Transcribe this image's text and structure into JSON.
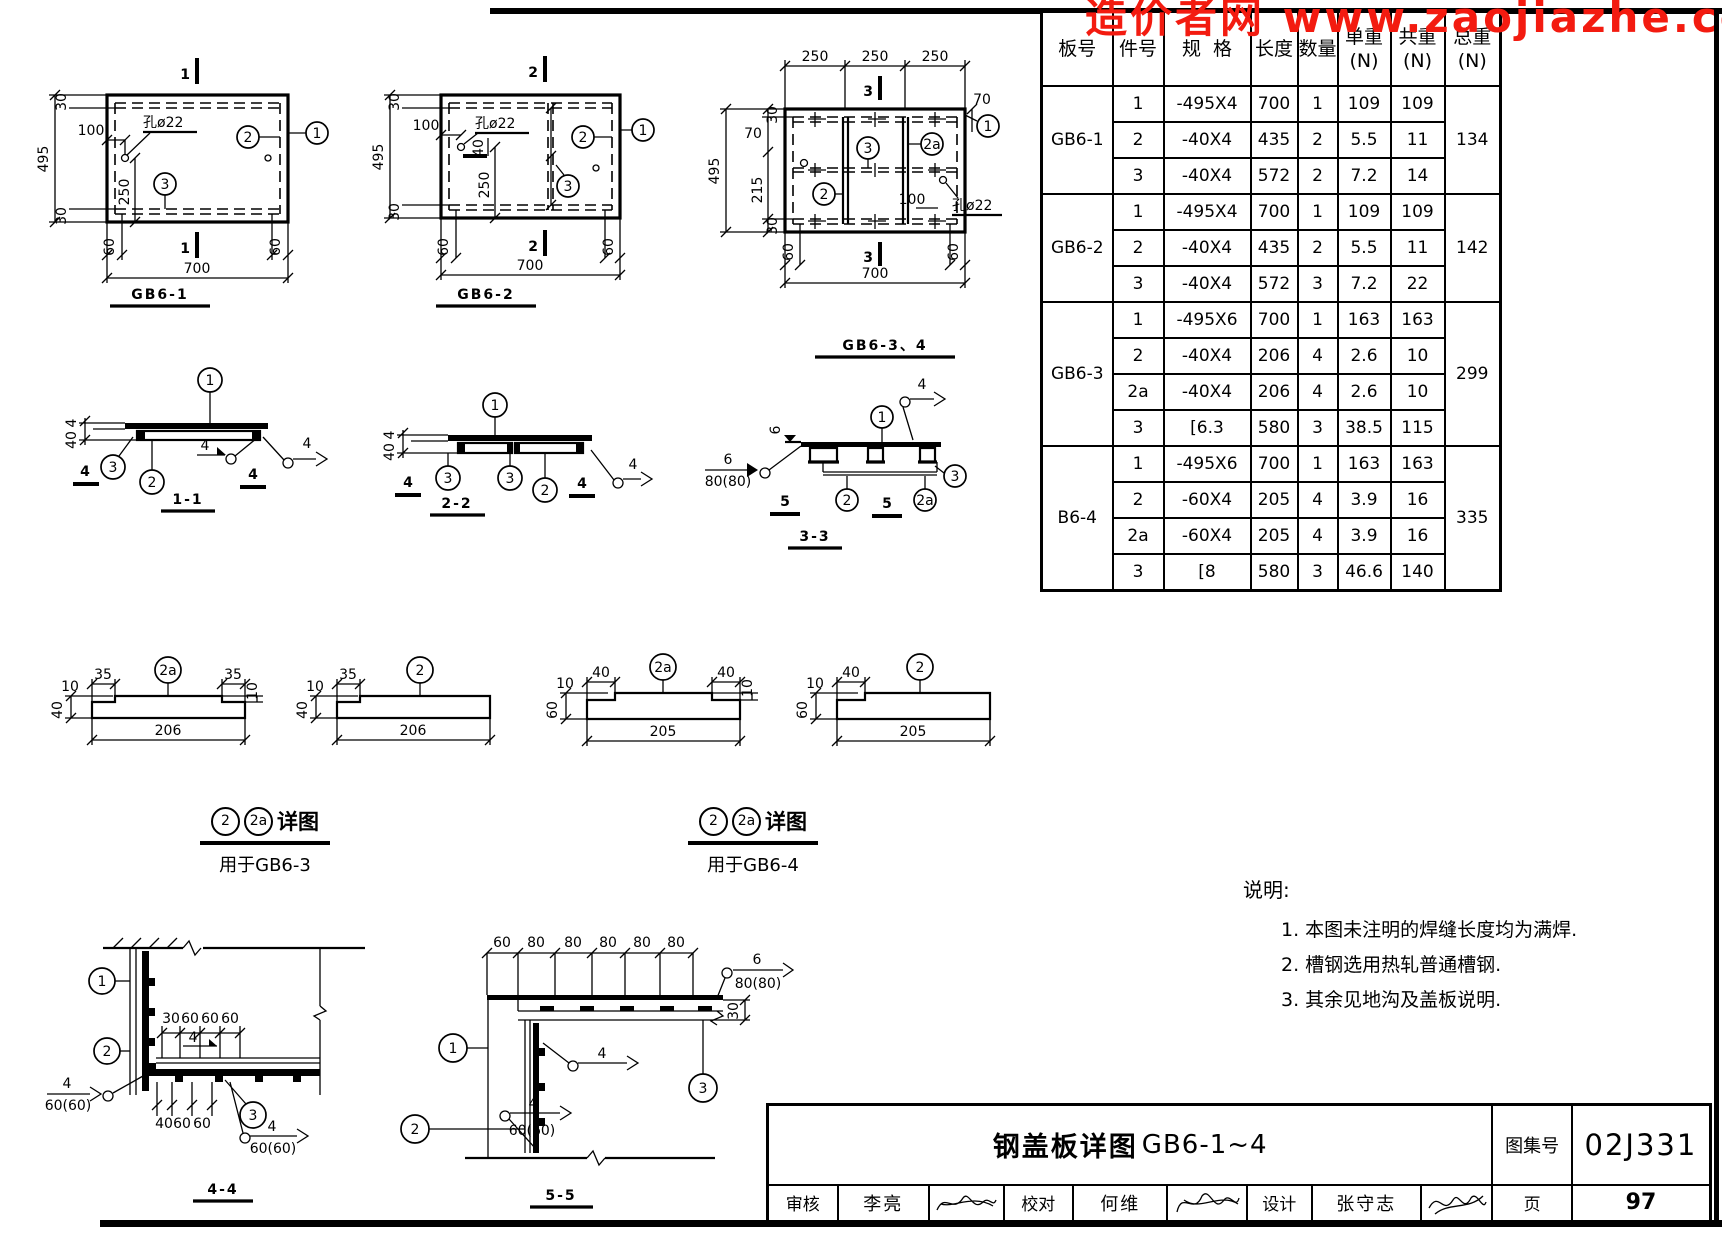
{
  "watermark": "造价者网 www.zaojiazhe.co",
  "table": {
    "headers": {
      "board": "板号",
      "item": "件号",
      "spec": "规  格",
      "len": "长度",
      "qty": "数量",
      "unit": "单重",
      "share": "共重",
      "sum": "总重",
      "n": "(N)"
    },
    "groups": [
      {
        "board": "GB6-1",
        "sum": "134",
        "rows": [
          {
            "item": "1",
            "spec": "-495X4",
            "len": "700",
            "qty": "1",
            "unit": "109",
            "tot": "109"
          },
          {
            "item": "2",
            "spec": "-40X4",
            "len": "435",
            "qty": "2",
            "unit": "5.5",
            "tot": "11"
          },
          {
            "item": "3",
            "spec": "-40X4",
            "len": "572",
            "qty": "2",
            "unit": "7.2",
            "tot": "14"
          }
        ]
      },
      {
        "board": "GB6-2",
        "sum": "142",
        "rows": [
          {
            "item": "1",
            "spec": "-495X4",
            "len": "700",
            "qty": "1",
            "unit": "109",
            "tot": "109"
          },
          {
            "item": "2",
            "spec": "-40X4",
            "len": "435",
            "qty": "2",
            "unit": "5.5",
            "tot": "11"
          },
          {
            "item": "3",
            "spec": "-40X4",
            "len": "572",
            "qty": "3",
            "unit": "7.2",
            "tot": "22"
          }
        ]
      },
      {
        "board": "GB6-3",
        "sum": "299",
        "rows": [
          {
            "item": "1",
            "spec": "-495X6",
            "len": "700",
            "qty": "1",
            "unit": "163",
            "tot": "163"
          },
          {
            "item": "2",
            "spec": "-40X4",
            "len": "206",
            "qty": "4",
            "unit": "2.6",
            "tot": "10"
          },
          {
            "item": "2a",
            "spec": "-40X4",
            "len": "206",
            "qty": "4",
            "unit": "2.6",
            "tot": "10"
          },
          {
            "item": "3",
            "spec": "[6.3",
            "len": "580",
            "qty": "3",
            "unit": "38.5",
            "tot": "115"
          }
        ]
      },
      {
        "board": "B6-4",
        "sum": "335",
        "rows": [
          {
            "item": "1",
            "spec": "-495X6",
            "len": "700",
            "qty": "1",
            "unit": "163",
            "tot": "163"
          },
          {
            "item": "2",
            "spec": "-60X4",
            "len": "205",
            "qty": "4",
            "unit": "3.9",
            "tot": "16"
          },
          {
            "item": "2a",
            "spec": "-60X4",
            "len": "205",
            "qty": "4",
            "unit": "3.9",
            "tot": "16"
          },
          {
            "item": "3",
            "spec": "[8",
            "len": "580",
            "qty": "3",
            "unit": "46.6",
            "tot": "140"
          }
        ]
      }
    ]
  },
  "notes": {
    "title": "说明:",
    "items": [
      "1. 本图未注明的焊缝长度均为满焊.",
      "2. 槽钢选用热轧普通槽钢.",
      "3. 其余见地沟及盖板说明."
    ]
  },
  "titleblock": {
    "title_cn": "钢盖板详图",
    "title_code": "GB6-1~4",
    "atlas_label": "图集号",
    "atlas_no": "02J331",
    "review_label": "审核",
    "reviewer": "李亮",
    "check_label": "校对",
    "checker": "何维",
    "design_label": "设计",
    "designer": "张守志",
    "page_label": "页",
    "page_no": "97"
  },
  "drawings": {
    "gb61": {
      "title": "GB6-1",
      "cut": "1",
      "hole": "孔ø22",
      "d495": "495",
      "d30t": "30",
      "d30b": "30",
      "d100": "100",
      "d250": "250",
      "d60l": "60",
      "d60r": "60",
      "d700": "700",
      "c1": "1",
      "c2": "2",
      "c3": "3"
    },
    "gb62": {
      "title": "GB6-2",
      "cut": "2",
      "hole": "孔ø22",
      "d495": "495",
      "d30t": "30",
      "d30b": "30",
      "d100": "100",
      "d40": "40",
      "d250": "250",
      "d60l": "60",
      "d60r": "60",
      "d700": "700",
      "c1": "1",
      "c2": "2",
      "c3": "3"
    },
    "gb634": {
      "title": "GB6-3、4",
      "cut": "3",
      "hole": "孔ø22",
      "d250a": "250",
      "d250b": "250",
      "d250c": "250",
      "d30t": "30",
      "d70l": "70",
      "d495": "495",
      "d215": "215",
      "d30b": "30",
      "d70r": "70",
      "d100": "100",
      "d60l": "60",
      "d60r": "60",
      "d700": "700",
      "c1": "1",
      "c2": "2",
      "c2a": "2a",
      "c3": "3"
    },
    "s11": {
      "label": "1-1",
      "d4": "4",
      "d40": "40",
      "cutl": "4",
      "cutr": "4",
      "w1": "4",
      "w2": "4",
      "c1": "1",
      "c2": "2",
      "c3": "3"
    },
    "s22": {
      "label": "2-2",
      "d4": "4",
      "d40": "40",
      "cutl": "4",
      "cutr": "4",
      "w1": "4",
      "c1": "1",
      "c2": "2",
      "c3a": "3",
      "c3b": "3"
    },
    "s33": {
      "label": "3-3",
      "d6": "6",
      "w6_num": "6",
      "w6_den": "80(80)",
      "w4": "4",
      "cutl": "5",
      "cutr": "5",
      "c1": "1",
      "c2": "2",
      "c2a": "2a",
      "c3": "3"
    },
    "det63a": {
      "c": "2a",
      "dl": "35",
      "dr": "35",
      "dlen": "206",
      "dh": "40",
      "dt1": "10",
      "dt2": "10"
    },
    "det63b": {
      "c": "2",
      "dl": "35",
      "dlen": "206",
      "dh": "40",
      "dt1": "10",
      "dt2": "10"
    },
    "det64a": {
      "c": "2a",
      "dl": "40",
      "dr": "40",
      "dlen": "205",
      "dh": "60",
      "dt1": "10",
      "dt2": "10"
    },
    "det64b": {
      "c": "2",
      "dl": "40",
      "dlen": "205",
      "dh": "60",
      "dt1": "10",
      "dt2": "10"
    },
    "detail_label_63": {
      "c2": "2",
      "c2a": "2a",
      "text": "详图",
      "sub": "用于GB6-3"
    },
    "detail_label_64": {
      "c2": "2",
      "c2a": "2a",
      "text": "详图",
      "sub": "用于GB6-4"
    },
    "s44": {
      "label": "4-4",
      "dims_top": [
        "30",
        "60",
        "60",
        "60"
      ],
      "dims_bot": [
        "40",
        "60",
        "60"
      ],
      "w_mid": "4",
      "wl_num": "4",
      "wl_den": "60(60)",
      "wr_num": "4",
      "wr_den": "60(60)",
      "c1": "1",
      "c2": "2",
      "c3": "3"
    },
    "s55": {
      "label": "5-5",
      "dims_top": [
        "60",
        "80",
        "80",
        "80",
        "80",
        "80"
      ],
      "d30": "30",
      "w6_num": "6",
      "w6_den": "80(80)",
      "w4": "4",
      "wl_num": "4",
      "wl_den": "60(60)",
      "c1": "1",
      "c2": "2",
      "c3": "3"
    }
  }
}
